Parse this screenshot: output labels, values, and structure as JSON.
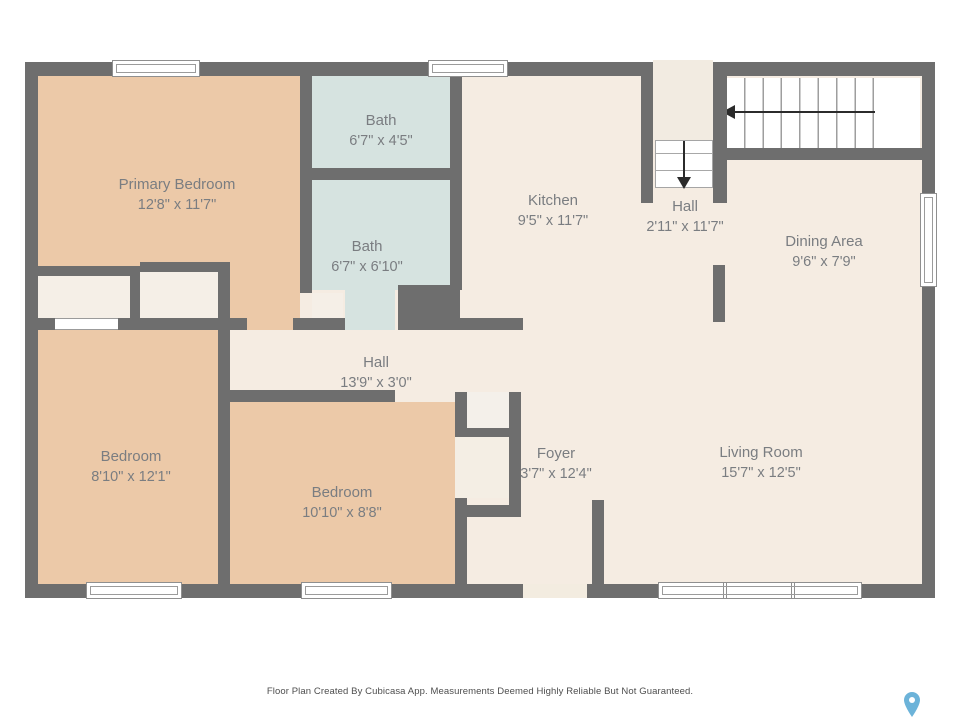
{
  "rooms": [
    {
      "name": "Primary Bedroom",
      "dims": "12'8\" x 11'7\""
    },
    {
      "name": "Bath",
      "dims": "6'7\" x 4'5\""
    },
    {
      "name": "Bath",
      "dims": "6'7\" x 6'10\""
    },
    {
      "name": "Kitchen",
      "dims": "9'5\" x 11'7\""
    },
    {
      "name": "Hall",
      "dims": "2'11\" x 11'7\""
    },
    {
      "name": "Dining Area",
      "dims": "9'6\" x 7'9\""
    },
    {
      "name": "Bedroom",
      "dims": "8'10\" x 12'1\""
    },
    {
      "name": "Hall",
      "dims": "13'9\" x 3'0\""
    },
    {
      "name": "Bedroom",
      "dims": "10'10\" x 8'8\""
    },
    {
      "name": "Foyer",
      "dims": "3'7\" x 12'4\""
    },
    {
      "name": "Living Room",
      "dims": "15'7\" x 12'5\""
    }
  ],
  "footer": {
    "disclaimer": "Floor Plan Created By Cubicasa App. Measurements Deemed Highly Reliable But Not Guaranteed."
  },
  "colors": {
    "wall": "#6e6e6e",
    "bedroom_fill": "#ecc9a8",
    "bath_fill": "#d6e3e0",
    "floor_fill": "#f5ece2",
    "closet_fill": "#f5efe7",
    "stairs_fill": "#ffffff",
    "label_text": "#7a7d81",
    "pin_blue": "#6cb3d9"
  }
}
